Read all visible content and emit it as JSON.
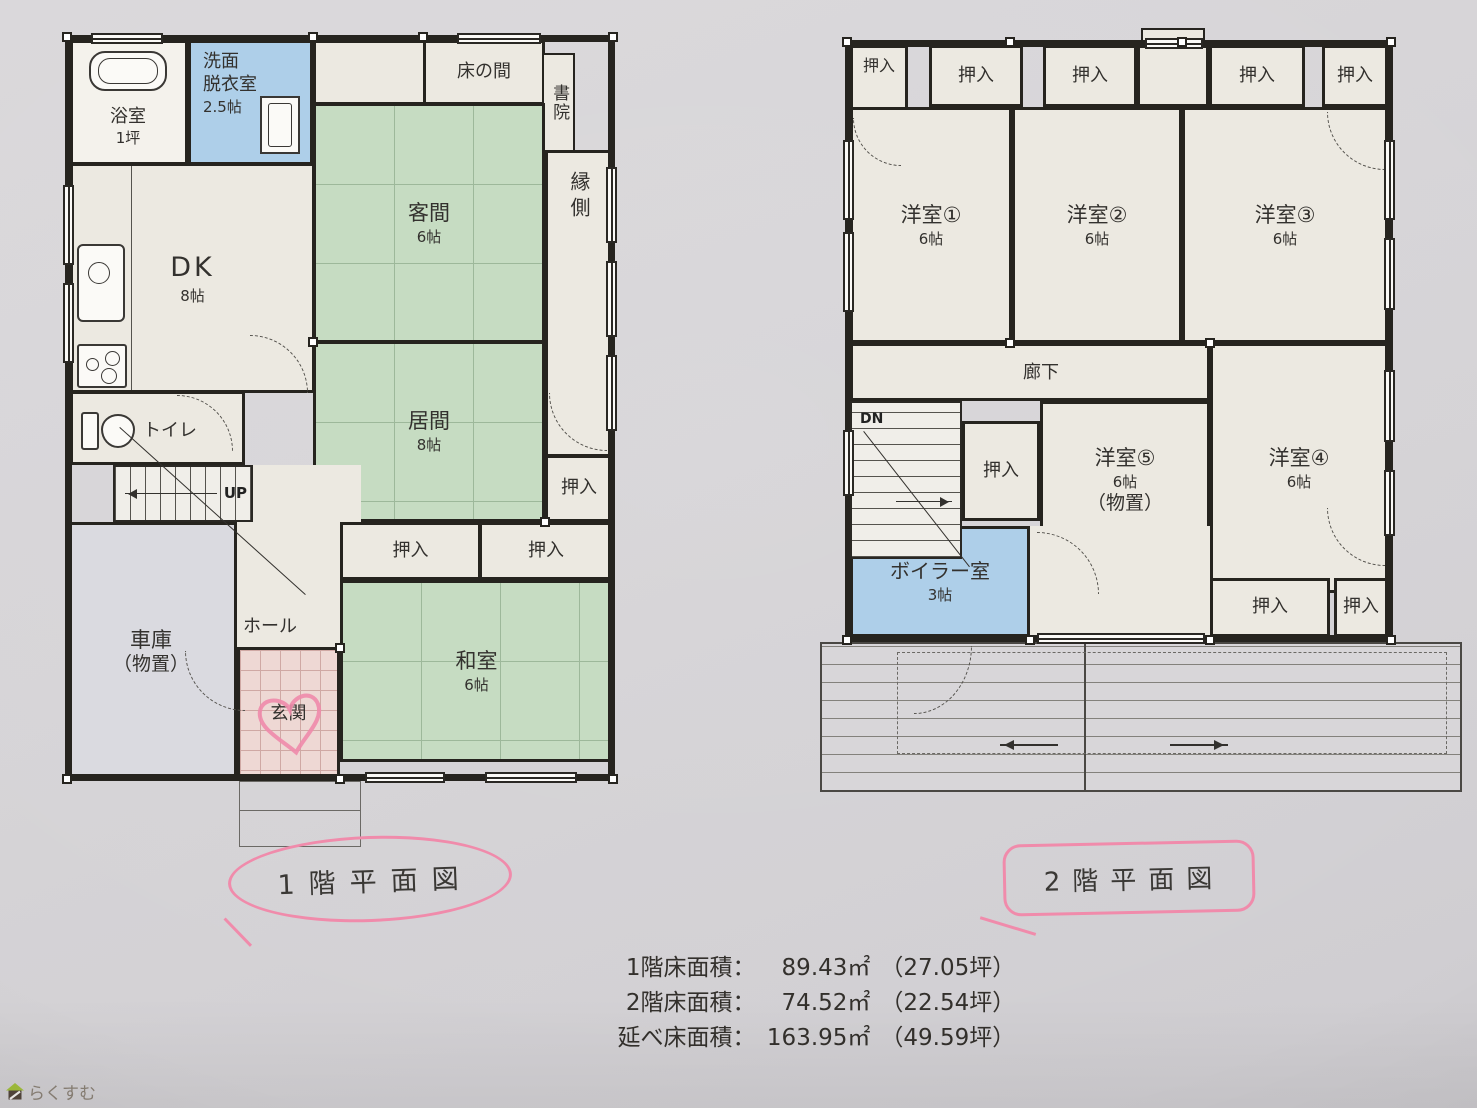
{
  "paper": {
    "background": "#d6d4d7"
  },
  "colors": {
    "wall": "#26241f",
    "tatami_green": "#c6dcc2",
    "water_blue": "#aecfe9",
    "genkan_pink": "#eed8d4",
    "garage_gray": "#dadae0",
    "room_cream": "#ece9e1",
    "marker_pink": "#f08bab"
  },
  "icons": {
    "bathtub": "bathtub-icon",
    "washing_machine": "washing-machine-icon",
    "toilet": "toilet-icon",
    "kitchen_sink": "kitchen-sink-icon",
    "stove": "stove-icon",
    "up_arrow": "up-arrow-icon",
    "roof_arrow_left": "arrow-left-icon",
    "roof_arrow_right": "arrow-right-icon",
    "heart": "heart-doodle",
    "house": "house-icon"
  },
  "floor1": {
    "title": "1階平面図",
    "rooms": {
      "bath": {
        "label": "浴室",
        "size": "1坪"
      },
      "washroom": {
        "line1": "洗面",
        "line2": "脱衣室",
        "size": "2.5帖"
      },
      "tokonoma": {
        "label": "床の間"
      },
      "shoin": {
        "label": "書院"
      },
      "guest": {
        "label": "客間",
        "size": "6帖"
      },
      "dk": {
        "label": "DK",
        "size": "8帖"
      },
      "engawa": {
        "label": "縁側"
      },
      "living": {
        "label": "居間",
        "size": "8帖"
      },
      "toilet": {
        "label": "トイレ"
      },
      "stairs": {
        "label": "UP"
      },
      "closet_right": {
        "label": "押入"
      },
      "closet_a": {
        "label": "押入"
      },
      "closet_b": {
        "label": "押入"
      },
      "hall": {
        "label": "ホール"
      },
      "garage": {
        "line1": "車庫",
        "line2": "（物置）"
      },
      "genkan": {
        "label": "玄関"
      },
      "washitsu": {
        "label": "和室",
        "size": "6帖"
      }
    }
  },
  "floor2": {
    "title": "2階平面図",
    "rooms": {
      "closet1": {
        "label": "押入"
      },
      "closet2": {
        "label": "押入"
      },
      "closet3": {
        "label": "押入"
      },
      "closet4": {
        "label": "押入"
      },
      "closet5": {
        "label": "押入"
      },
      "yoshitsu1": {
        "label": "洋室①",
        "size": "6帖"
      },
      "yoshitsu2": {
        "label": "洋室②",
        "size": "6帖"
      },
      "yoshitsu3": {
        "label": "洋室③",
        "size": "6帖"
      },
      "rouka": {
        "label": "廊下"
      },
      "stairs": {
        "label": "DN"
      },
      "closet_mid": {
        "label": "押入"
      },
      "yoshitsu5": {
        "label": "洋室⑤",
        "size": "6帖",
        "note": "（物置）"
      },
      "yoshitsu4": {
        "label": "洋室④",
        "size": "6帖"
      },
      "boiler": {
        "label": "ボイラー室",
        "size": "3帖"
      },
      "closet_b1": {
        "label": "押入"
      },
      "closet_b2": {
        "label": "押入"
      }
    }
  },
  "areas": {
    "row1": {
      "label": "1階床面積：",
      "value": "89.43㎡",
      "tsubo": "（27.05坪）"
    },
    "row2": {
      "label": "2階床面積：",
      "value": "74.52㎡",
      "tsubo": "（22.54坪）"
    },
    "row3": {
      "label": "延べ床面積：",
      "value": "163.95㎡",
      "tsubo": "（49.59坪）"
    }
  },
  "watermark": {
    "text": "らくすむ"
  }
}
